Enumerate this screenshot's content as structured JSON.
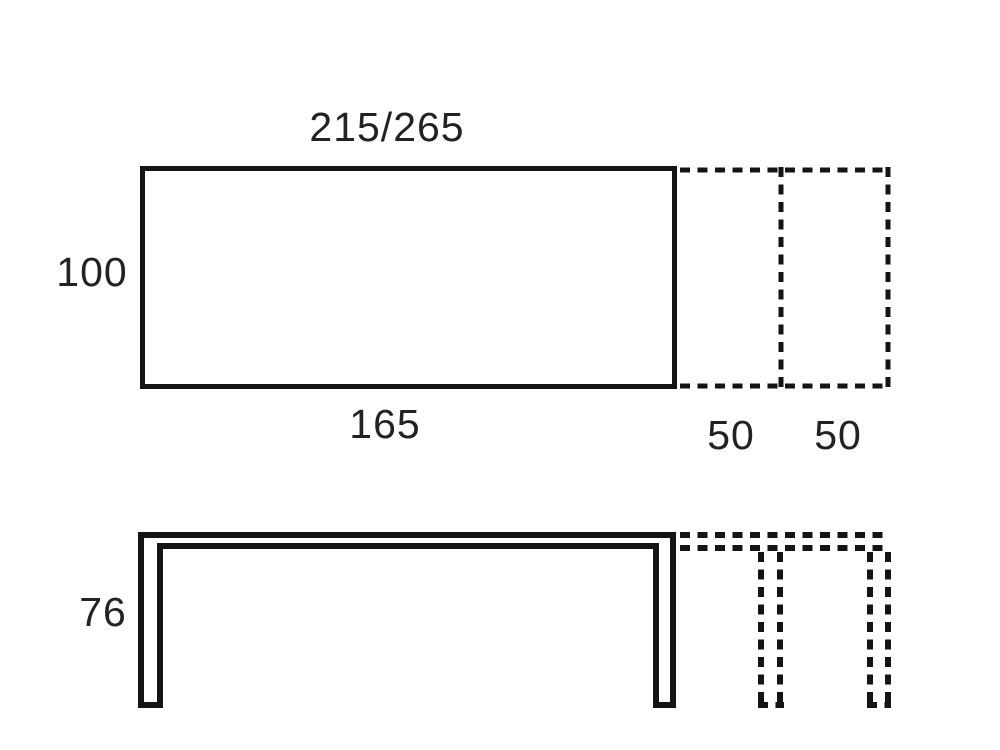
{
  "diagram": {
    "background_color": "#ffffff",
    "line_color": "#141414",
    "text_color": "#222222",
    "plan_view": {
      "total_length_label": "215/265",
      "depth_label": "100",
      "table_length_label": "165",
      "extension_left_label": "50",
      "extension_right_label": "50"
    },
    "side_view": {
      "height_label": "76"
    }
  }
}
